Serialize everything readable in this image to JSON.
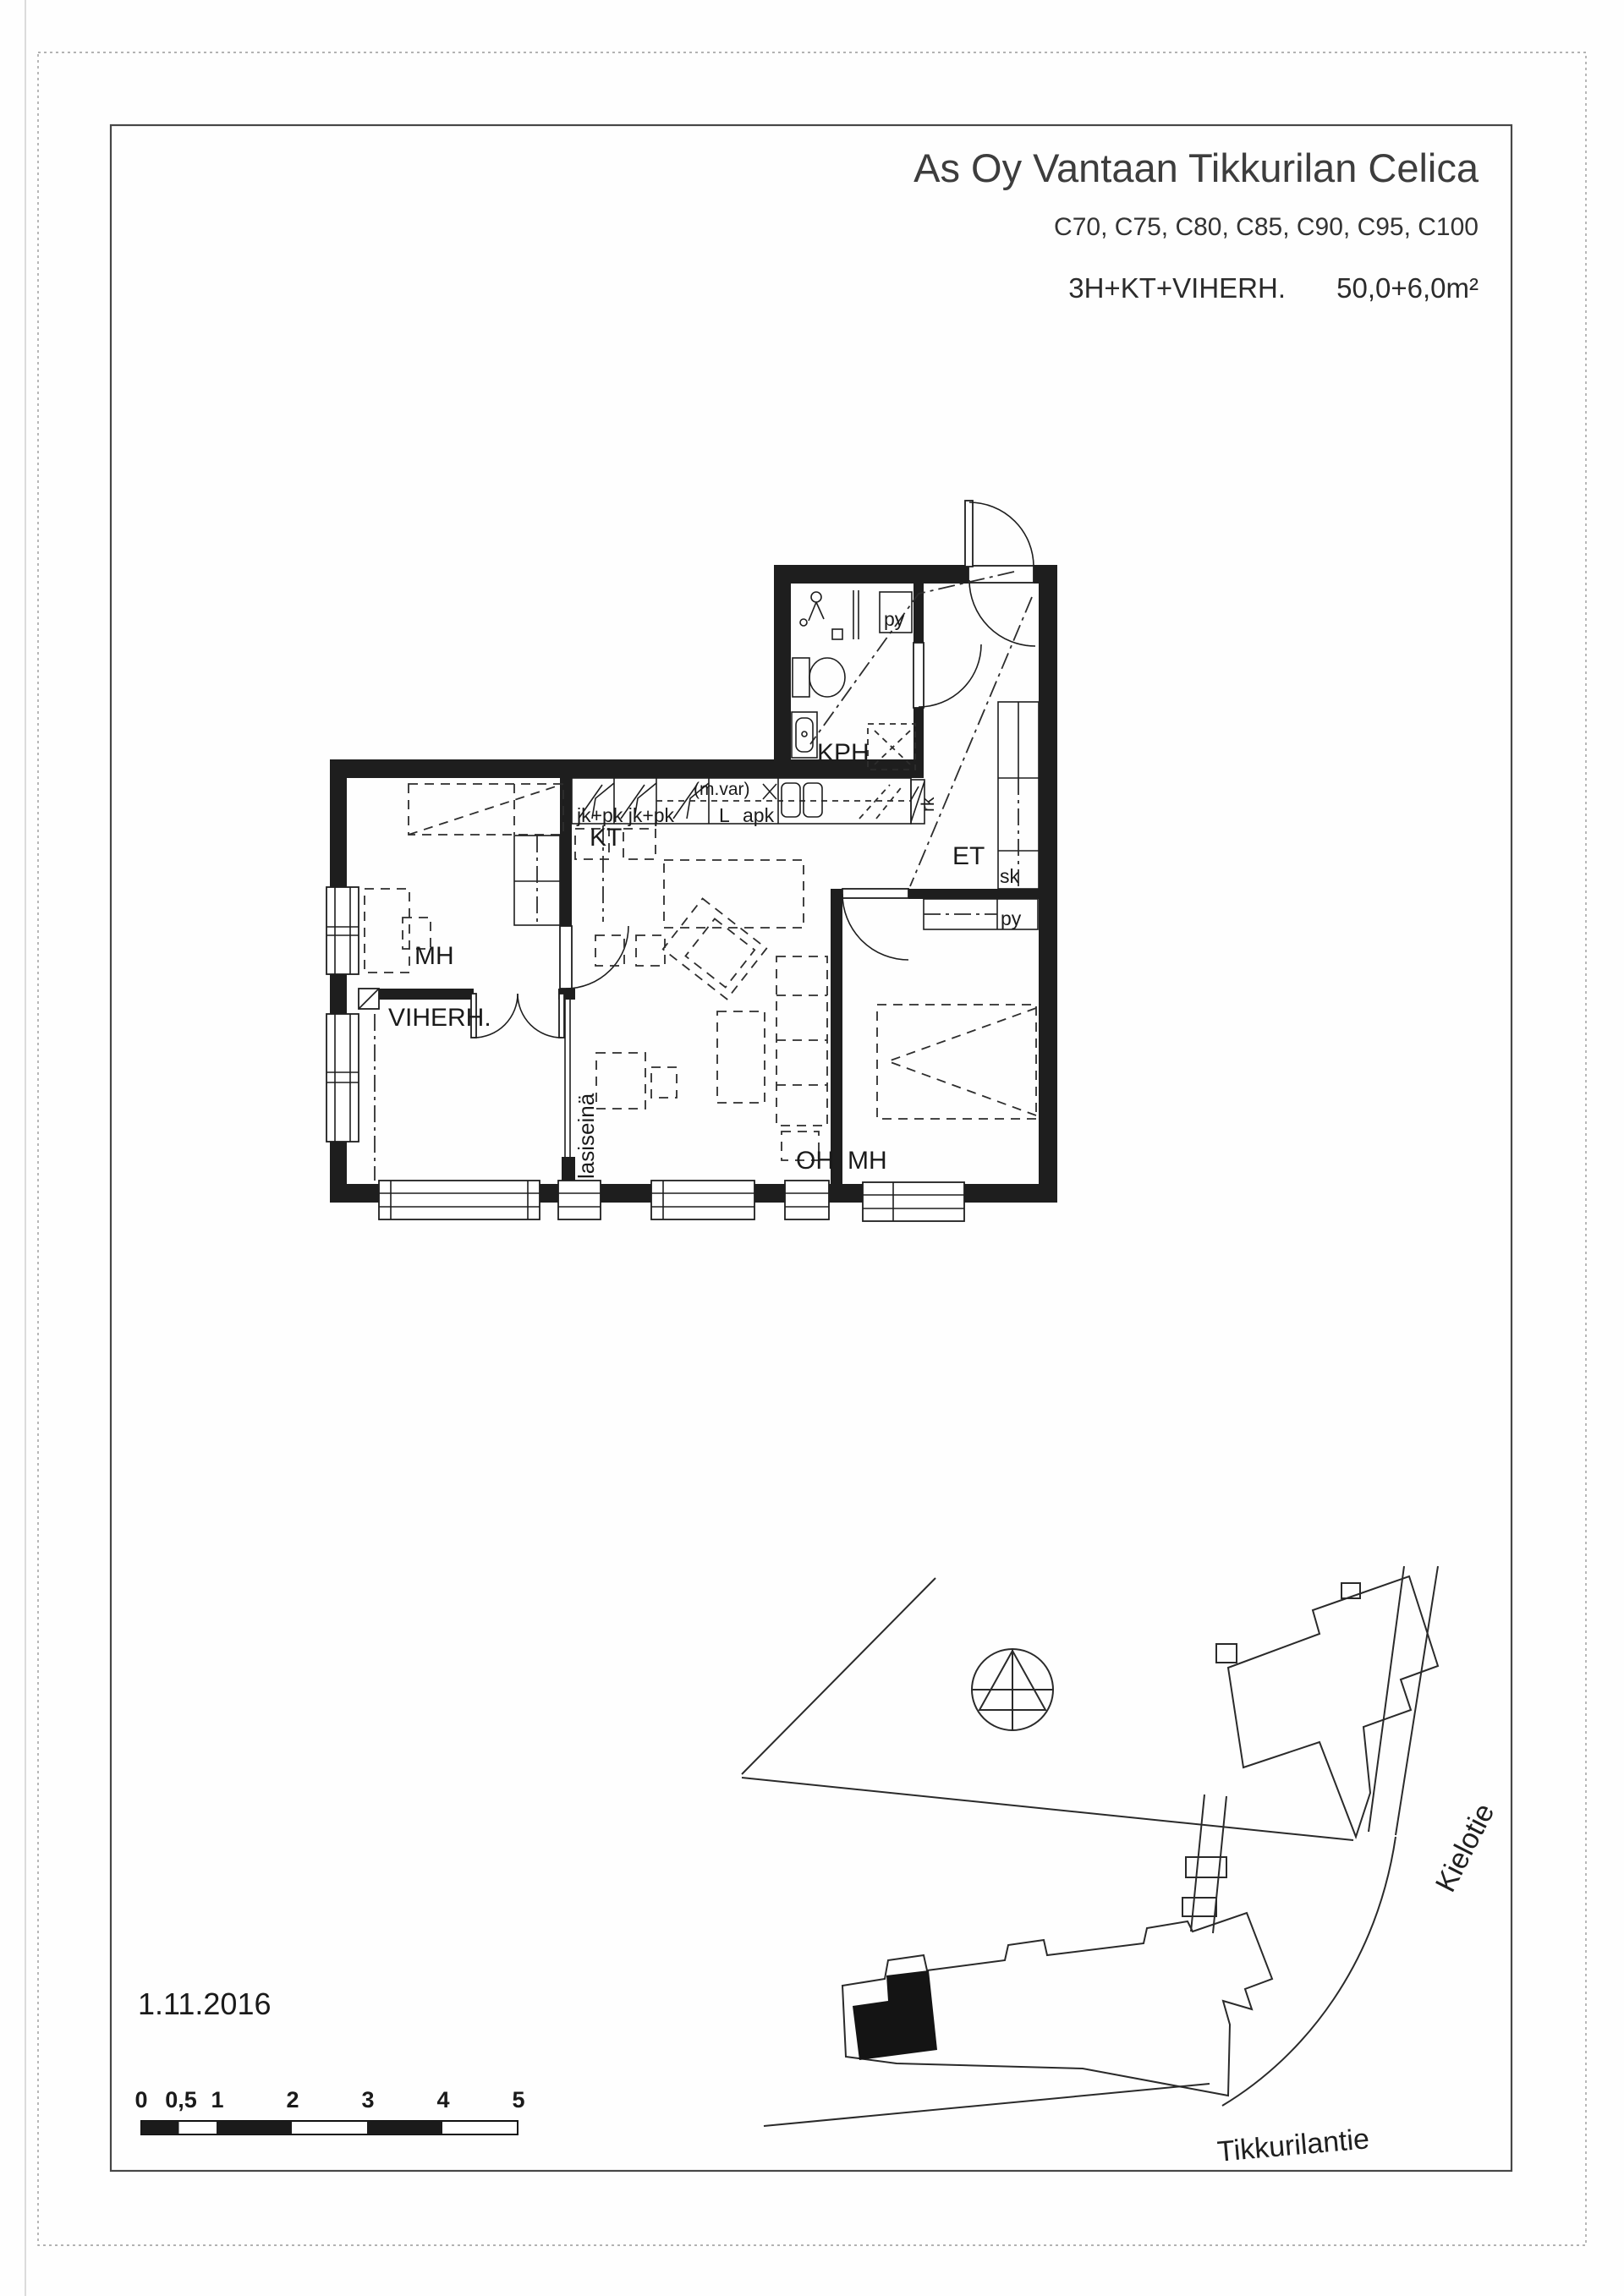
{
  "header": {
    "title": "As Oy Vantaan Tikkurilan Celica",
    "units": "C70, C75, C80, C85, C90, C95, C100",
    "apartment_type": "3H+KT+VIHERH.",
    "area": "50,0+6,0m²"
  },
  "plan": {
    "rooms": {
      "kph": "KPH",
      "kt": "KT",
      "et": "ET",
      "mh_left": "MH",
      "viherh": "VIHERH.",
      "oh": "OH",
      "mh_right": "MH"
    },
    "fixtures": {
      "py_bath": "py",
      "py_bedroom": "py",
      "closet_sk": "sk",
      "cabinet_rk": "rk",
      "fridges": "jk+pk jk+pk",
      "stove": "L",
      "dishwasher": "apk",
      "reservation": "(m.var)",
      "glass_wall": "lasiseinä"
    }
  },
  "site": {
    "street_right": "Kielotie",
    "street_bottom": "Tikkurilantie"
  },
  "footer": {
    "date": "1.11.2016"
  },
  "scale": {
    "labels": [
      "0",
      "0,5",
      "1",
      "2",
      "3",
      "4",
      "5"
    ]
  }
}
